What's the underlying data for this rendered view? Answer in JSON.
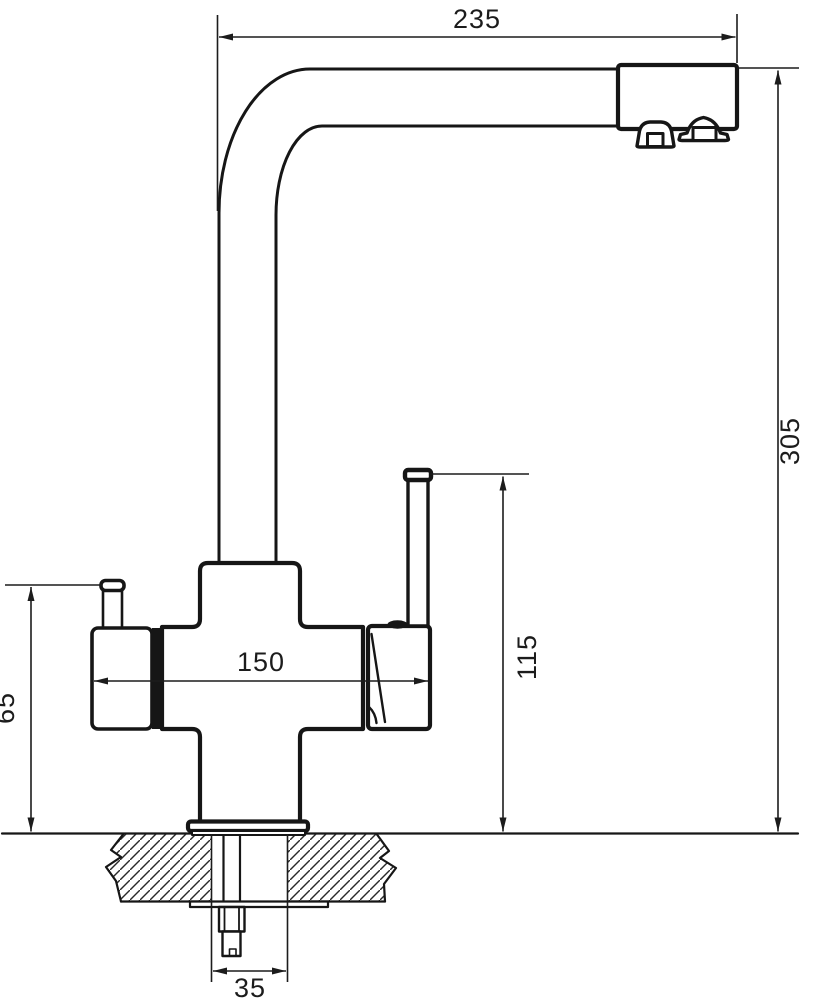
{
  "drawing": {
    "kind": "technical-dimension-drawing",
    "subject": "kitchen-faucet-with-filter-channel-side-view",
    "colors": {
      "line": "#161616",
      "background": "#ffffff"
    },
    "dimensions": {
      "spout_reach": "235",
      "overall_height": "305",
      "body_span": "150",
      "lever_height": "115",
      "knob_height": "65",
      "hole_diameter": "35"
    }
  }
}
